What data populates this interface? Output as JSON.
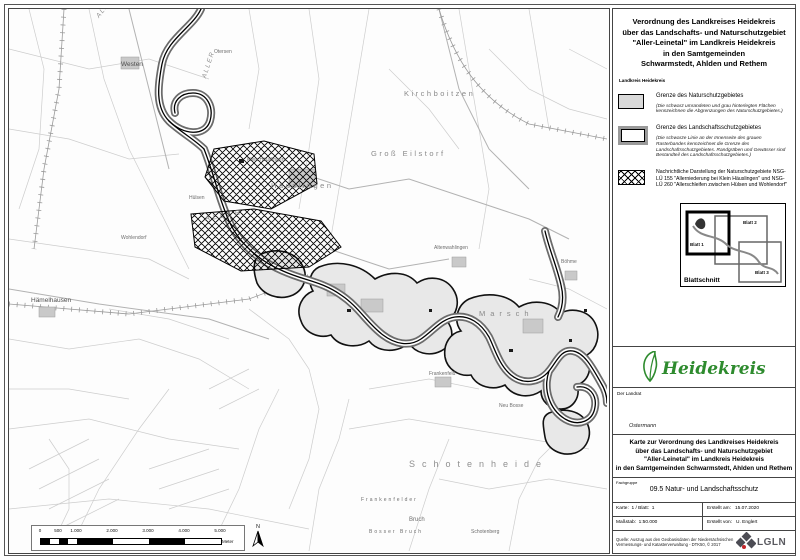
{
  "title_block": {
    "lines": [
      "Verordnung des Landkreises Heidekreis",
      "über das Landschafts- und Naturschutzgebiet",
      "\"Aller-Leinetal\" im Landkreis Heidekreis",
      "in den Samtgemeinden",
      "Schwarmstedt, Ahlden und Rethem"
    ],
    "subtitle": "Landkreis Heidekreis"
  },
  "legend": {
    "items": [
      {
        "title": "Grenze des Naturschutzgebietes",
        "note": "(Die schwarz umrandeten und grau hinterlegten Flächen kennzeichnen die Abgrenzungen des Naturschutzgebietes.)"
      },
      {
        "title": "Grenze des Landschaftsschutzgebietes",
        "note": "(Die schwarze Linie an der Innenseite des grauen Rasterbandes kennzeichnet die Grenze des Landschaftsschutzgebietes. Randgräben und Gewässer sind Bestandteil des Landschaftsschutzgebietes.)"
      },
      {
        "title": "Nachrichtliche Darstellung der Naturschutzgebiete NSG-LÜ 155 \"Allerniederung bei Klein Häuslingen\" und NSG-LÜ 260 \"Allerschleifen zwischen Hülsen und Wohlendorf\""
      }
    ]
  },
  "blattschnitt": {
    "label": "Blattschnitt",
    "sheets": [
      "Blatt 1",
      "Blatt 2",
      "Blatt 3"
    ]
  },
  "logo": {
    "text": "Heidekreis",
    "color": "#2e8b2e"
  },
  "sign_block": {
    "role": "Der Landrat",
    "signature": "Ostermann"
  },
  "map_title_block": {
    "lines": [
      "Karte zur Verordnung des Landkreises Heidekreis",
      "über das Landschafts- und Naturschutzgebiet",
      "\"Aller-Leinetal\" im Landkreis Heidekreis",
      "in den Samtgemeinden Schwarmstedt, Ahlden und Rethem"
    ]
  },
  "fachgruppe": {
    "label": "Fachgruppe",
    "value": "09.5 Natur- und Landschaftsschutz"
  },
  "info_table": {
    "karte": "Karte:  1 / Blatt:  1",
    "massstab": "Maßstab:  1:50.000",
    "erstellt_am": "Erstellt am:   15.07.2020",
    "erstellt_von": "Erstellt von:   U. Englert"
  },
  "source": {
    "text": "Quelle: Auszug aus den Geobasisdaten der Niedersächsischen Vermessungs- und Katasterverwaltung - DTK50,  © 2017",
    "logo_text": "LGLN",
    "logo_red": "#c4252b",
    "logo_gray": "#4c4c54"
  },
  "scalebar": {
    "ticks": [
      "0",
      "500",
      "1.000",
      "2.000",
      "3.000",
      "4.000",
      "5.000"
    ],
    "unit": "Meter",
    "north": "N"
  },
  "map": {
    "labels": [
      {
        "text": "Westen"
      },
      {
        "text": "ALLER"
      },
      {
        "text": "ALLER"
      },
      {
        "text": "ALLER"
      },
      {
        "text": "Häuslingen"
      },
      {
        "text": "Klein Häuslingen"
      },
      {
        "text": "Hülsen"
      },
      {
        "text": "Hämelhausen"
      },
      {
        "text": "Altenwahlingen"
      },
      {
        "text": "Böhme"
      },
      {
        "text": "Otersen"
      },
      {
        "text": "Marsch"
      },
      {
        "text": "Frankenfeld"
      },
      {
        "text": "Neu Bosse"
      },
      {
        "text": "Schotenheide"
      },
      {
        "text": "Bruch"
      },
      {
        "text": "Frankenfelder"
      },
      {
        "text": "Bosser Bruch"
      },
      {
        "text": "Schotenberg"
      },
      {
        "text": "Wohlendorf"
      },
      {
        "text": "Kirchboitzen"
      },
      {
        "text": "Groß Eilstorf"
      }
    ]
  }
}
